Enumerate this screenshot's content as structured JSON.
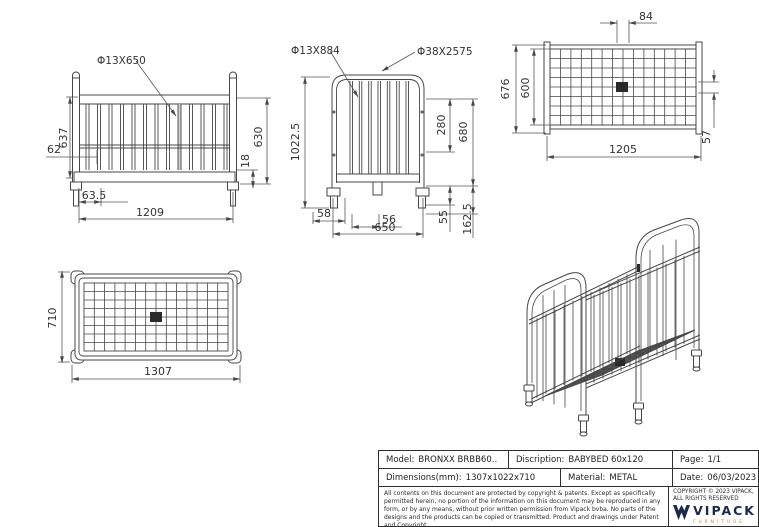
{
  "views": {
    "front": {
      "callout": "Φ13X650",
      "side_height": "637",
      "rail_offset": "62",
      "foot_offset": "63.5",
      "width": "1209",
      "base_gap": "18",
      "inner_height": "630"
    },
    "side": {
      "callout_bar": "Φ13X884",
      "callout_frame": "Φ38X2575",
      "total_height": "1022.5",
      "upper": "280",
      "inner_height": "680",
      "foot_offset": "58",
      "bar_gap": "56",
      "width": "650",
      "base_band": "55",
      "foot_height": "162.5"
    },
    "base_top": {
      "slat_gap": "84",
      "outer_depth": "676",
      "inner_depth": "600",
      "width": "1205",
      "side_gap": "57"
    },
    "crib_top": {
      "depth": "710",
      "width": "1307"
    }
  },
  "title_block": {
    "model_label": "Model:",
    "model_value": "BRONXX BRBB60..",
    "description_label": "Discription:",
    "description_value": "BABYBED 60x120",
    "page_label": "Page:",
    "page_value": "1/1",
    "dimensions_label": "Dimensions(mm):",
    "dimensions_value": "1307x1022x710",
    "material_label": "Material:",
    "material_value": "METAL",
    "date_label": "Date:",
    "date_value": "06/03/2023",
    "legal": "All contents on this document are protected by copyright & patents. Except as specifically permitted herein, no portion of the information on this document may be reproduced in any form, or by any means, without prior written permission from Vipack bvba. No parts of the designs and the products can be copied or transmitted. Product and drawings under Patent and Copyright.",
    "copyright_line1": "COPYRIGHT  © 2023 VIPACK,",
    "copyright_line2": "ALL RIGHTS RESERVED",
    "logo_text": "VIPACK",
    "logo_subtext": "FURNITURE",
    "logo_color": "#1d2947",
    "logo_accent_color": "#bf7e3e",
    "line_color": "#474747"
  }
}
